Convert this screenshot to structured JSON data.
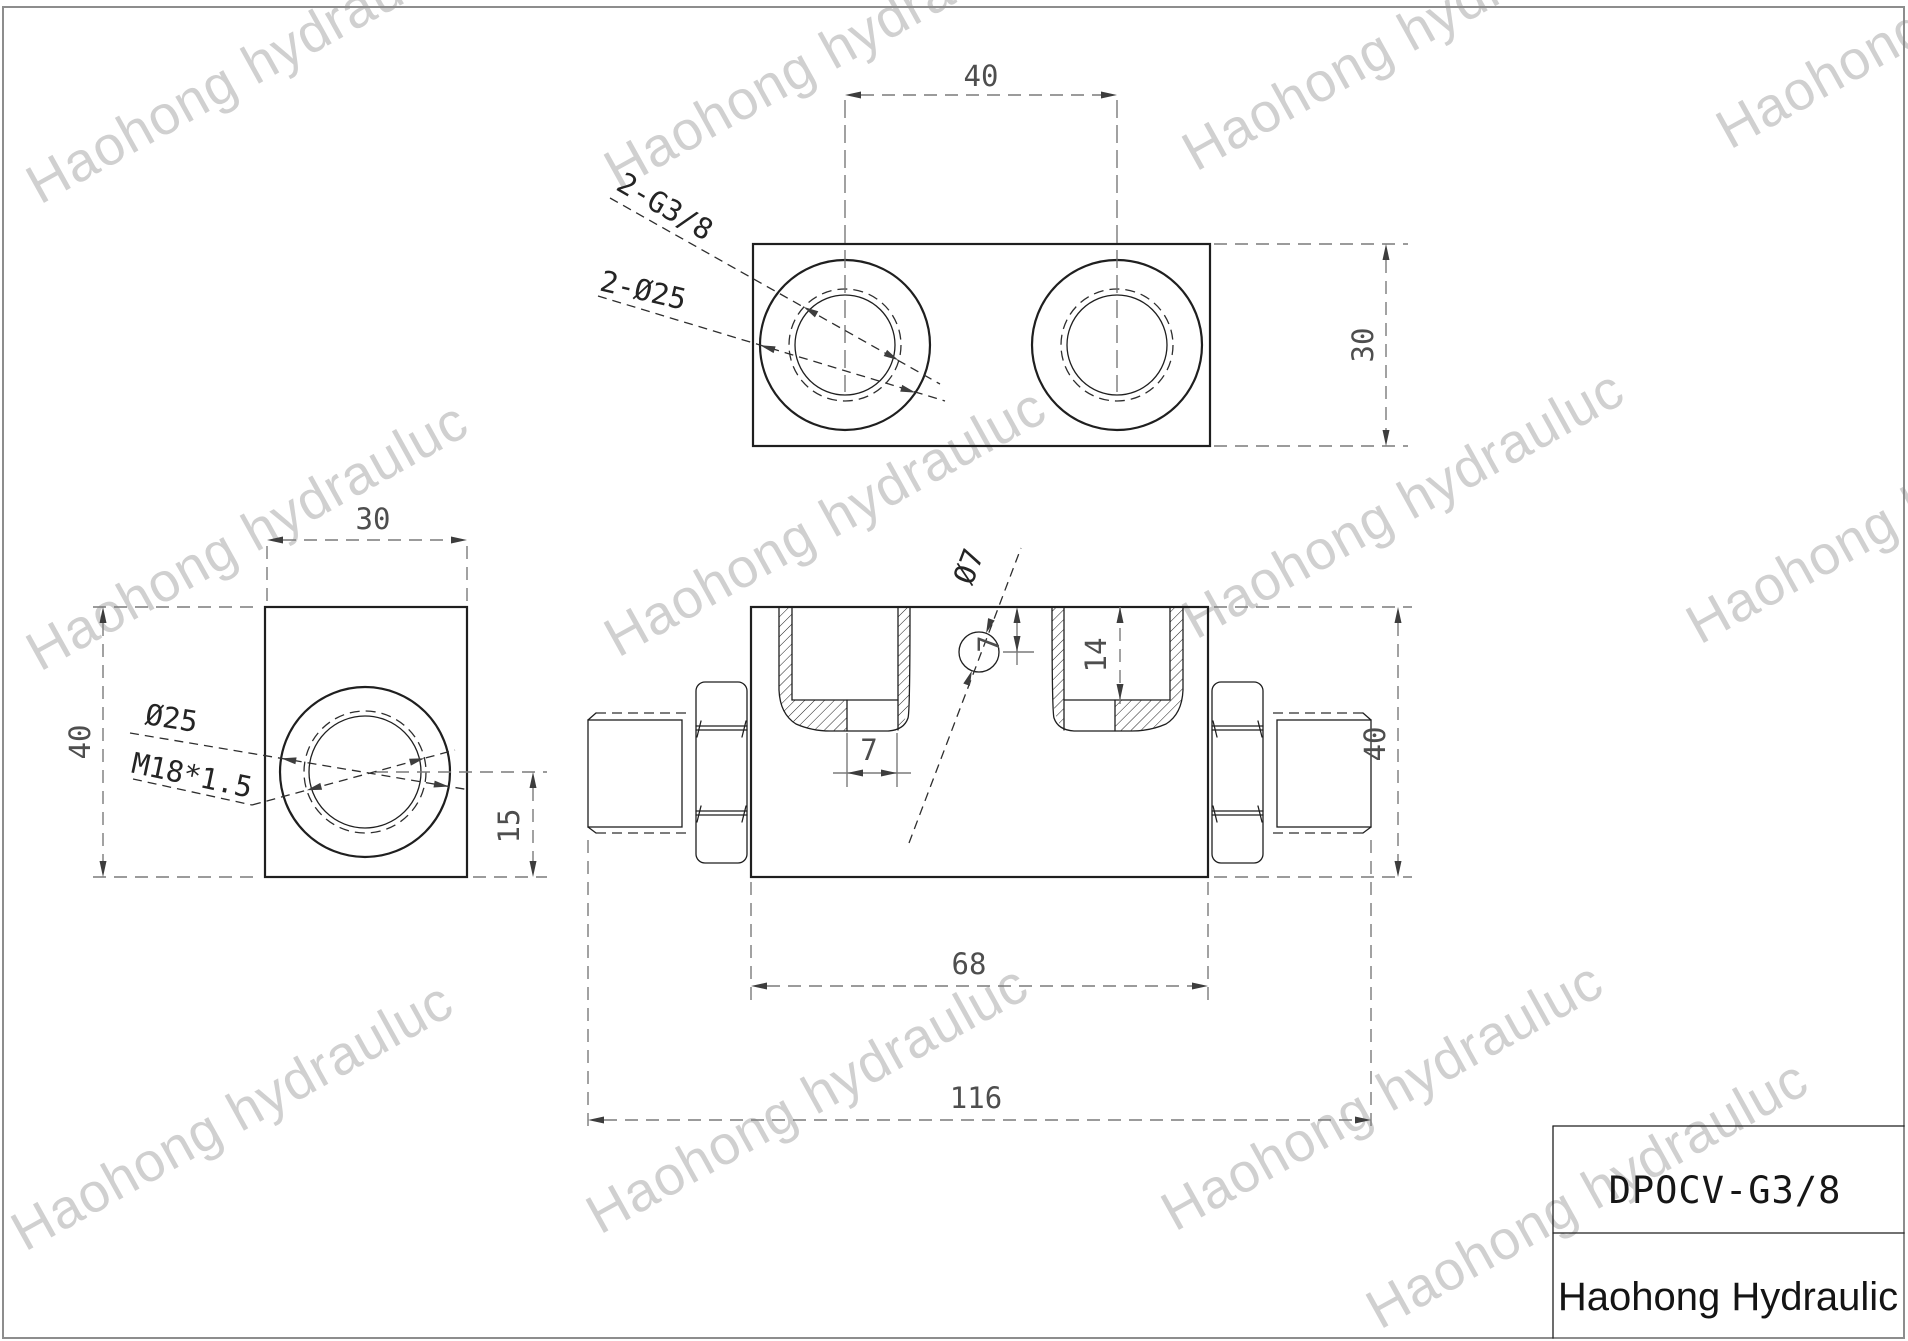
{
  "drawing": {
    "watermark": "Haohong hydrauluc",
    "title_block": {
      "model": "DPOCV-G3/8",
      "company": "Haohong Hydraulic"
    },
    "top_view": {
      "port_spacing": "40",
      "height": "30",
      "thread_label": "2-G3/8",
      "bore_label": "2-Ø25"
    },
    "side_view": {
      "width": "30",
      "height": "40",
      "port_center_height": "15",
      "bore_label": "Ø25",
      "thread_label": "M18*1.5"
    },
    "section_view": {
      "body_length": "68",
      "overall_length": "116",
      "height": "40",
      "port_depth": "14",
      "pilot_offset": "7",
      "pilot_depth": "7",
      "pilot_label": "Ø7"
    }
  }
}
